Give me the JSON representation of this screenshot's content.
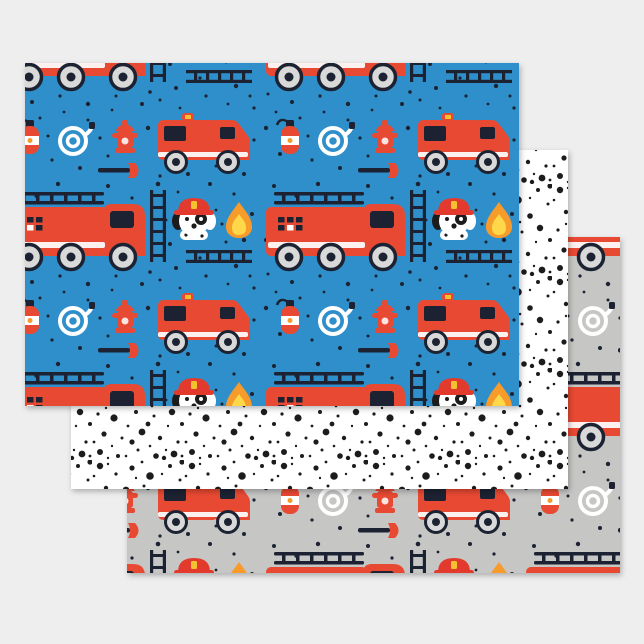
{
  "image_type": "product-photo",
  "product": {
    "name": "Fire truck dalmatian kids wrapping paper flat sheet set of 3"
  },
  "palette": {
    "page-bg": "#eeeeee",
    "paper-blue": "#2f8fca",
    "paper-gray": "#c6c6c5",
    "paper-white": "#ffffff",
    "truck-red": "#e84a31",
    "dark-navy": "#1a2430",
    "wheel-gray": "#d9d9d9",
    "stripe-white": "#ffffff",
    "flame-orange": "#f79b2c",
    "flame-yellow": "#ffd84a",
    "helmet-red": "#e23b2e",
    "badge-yellow": "#f6c12f",
    "spot-black": "#1d1d1f"
  },
  "sheets": [
    {
      "id": "firetruck-blue",
      "name": "Blue sheet with red fire trucks, dalmatian puppies, flames, hydrants and speckle dots",
      "background": "#2f8fca",
      "motifs": [
        "fire-engine",
        "ladder-truck",
        "dalmatian-puppy",
        "flame",
        "fire-extinguisher",
        "fire-hydrant",
        "hose-coil",
        "axe",
        "ladder",
        "ladder-tower",
        "speckle-dots"
      ],
      "layer": "front"
    },
    {
      "id": "dalmatian-spots",
      "name": "White sheet with scattered black dalmatian spots",
      "background": "#ffffff",
      "motifs": [
        "spot-dots"
      ],
      "layer": "middle"
    },
    {
      "id": "firetruck-gray",
      "name": "Gray sheet with red fire trucks, dalmatian puppies, flames, hydrants and speckle dots",
      "background": "#c6c6c5",
      "motifs": [
        "fire-engine",
        "ladder-truck",
        "dalmatian-puppy",
        "flame",
        "fire-extinguisher",
        "fire-hydrant",
        "hose-coil",
        "axe",
        "ladder",
        "ladder-tower",
        "speckle-dots"
      ],
      "layer": "back"
    }
  ]
}
